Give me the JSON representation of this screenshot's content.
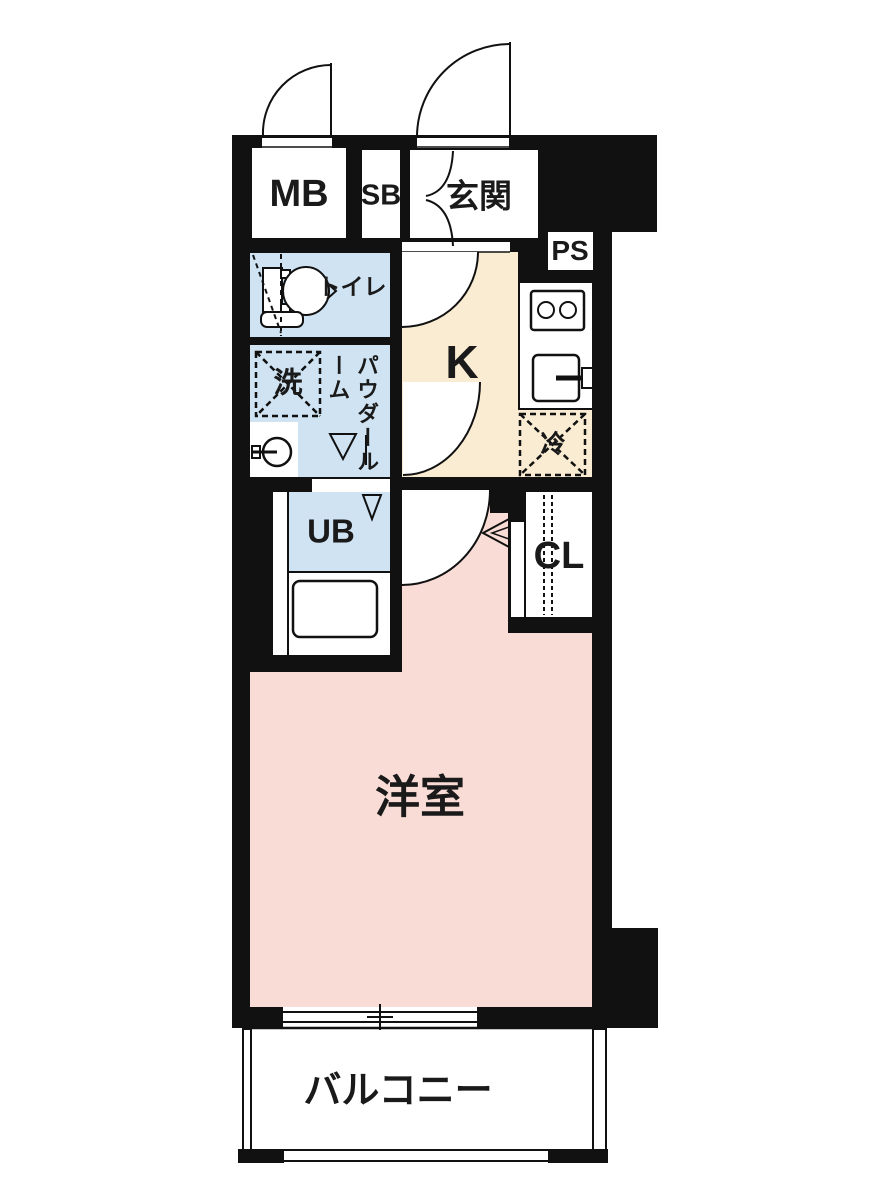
{
  "floor_plan": {
    "rooms": {
      "meter_box": "MB",
      "shoe_box": "SB",
      "entrance": "玄関",
      "pipe_space": "PS",
      "toilet": "トイレ",
      "washer": "洗",
      "powder_room": "パウダールーム",
      "kitchen": "K",
      "refrigerator": "冷",
      "unit_bath": "UB",
      "closet": "CL",
      "western_room": "洋室",
      "balcony": "バルコニー"
    },
    "colors": {
      "wall": "#111111",
      "wet_area_fill": "#cfe3f2",
      "kitchen_fill": "#faecd2",
      "room_fill": "#f9dcd6",
      "background": "#ffffff"
    }
  }
}
